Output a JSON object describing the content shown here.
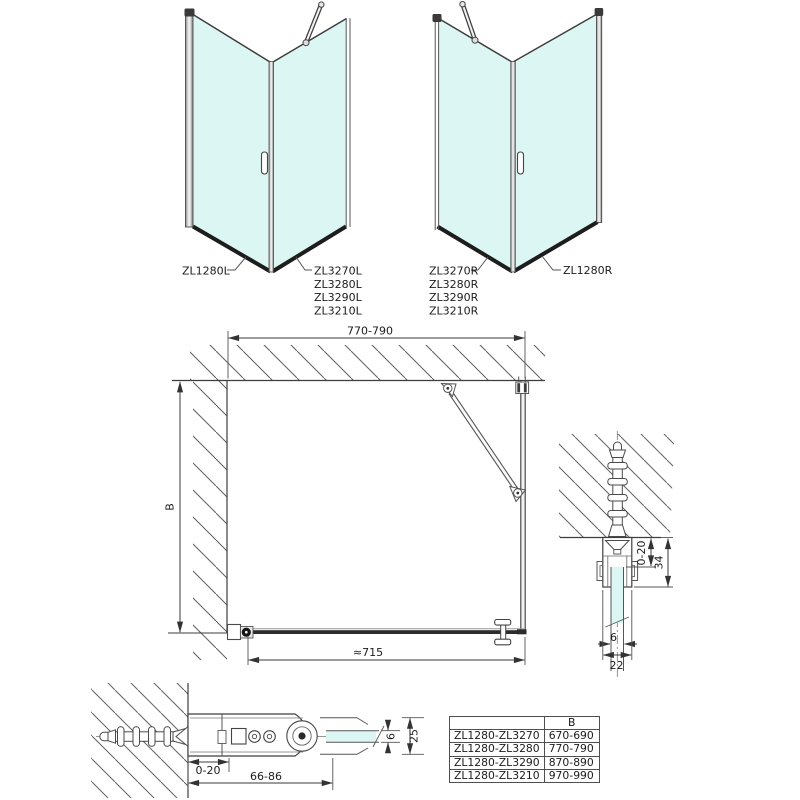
{
  "unit_left": {
    "door_label": "ZL1280L",
    "panel_labels": [
      "ZL3270L",
      "ZL3280L",
      "ZL3290L",
      "ZL3210L"
    ]
  },
  "unit_right": {
    "door_label": "ZL1280R",
    "panel_labels": [
      "ZL3270R",
      "ZL3280R",
      "ZL3290R",
      "ZL3210R"
    ]
  },
  "plan_view": {
    "width_dim": "770-790",
    "depth_dim": "B",
    "door_dim": "≈715"
  },
  "wall_profile_section": {
    "adjustment_dim": "0-20",
    "profile_depth_dim": "34",
    "glass_thickness_dim": "6",
    "profile_width_dim": "22"
  },
  "hinge_section": {
    "adjustment_dim": "0-20",
    "hinge_span_dim": "66-86",
    "glass_thickness_dim": "6",
    "profile_height_dim": "25"
  },
  "size_table": {
    "model_header": "",
    "width_header": "B",
    "rows": [
      {
        "model": "ZL1280-ZL3270",
        "width": "670-690"
      },
      {
        "model": "ZL1280-ZL3280",
        "width": "770-790"
      },
      {
        "model": "ZL1280-ZL3290",
        "width": "870-890"
      },
      {
        "model": "ZL1280-ZL3210",
        "width": "970-990"
      }
    ]
  },
  "colors": {
    "glass": "#dcf6f3",
    "line": "#3d3d3d",
    "dim": "#3a3a3a",
    "thick_edge": "#1d1d1d"
  }
}
